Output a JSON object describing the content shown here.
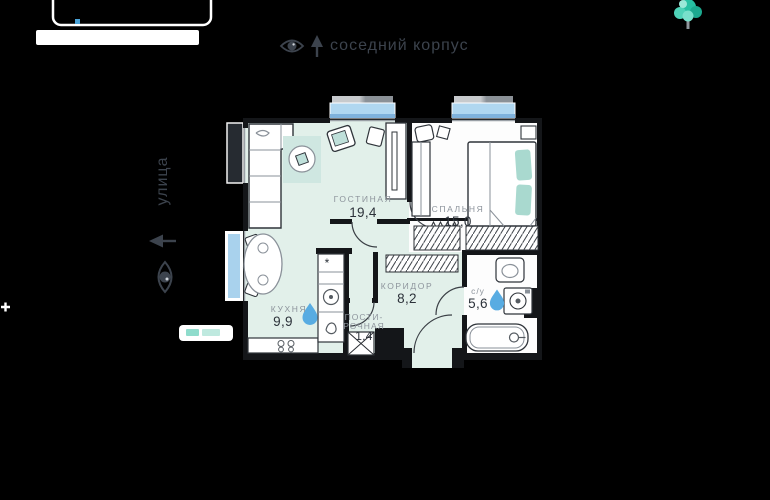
{
  "canvas": {
    "background": "#000000"
  },
  "annotations": {
    "top": {
      "icon": "eye-icon",
      "arrow": "up",
      "text": "соседний корпус"
    },
    "left": {
      "icon": "eye-icon",
      "arrow": "left",
      "text": "улица"
    }
  },
  "plan": {
    "rooms": [
      {
        "key": "living",
        "name": "ГОСТИНАЯ",
        "area": "19,4"
      },
      {
        "key": "bedroom",
        "name": "СПАЛЬНЯ",
        "area": "15,0"
      },
      {
        "key": "kitchen",
        "name": "КУХНЯ",
        "area": "9,9",
        "water": true
      },
      {
        "key": "corridor",
        "name": "КОРИДОР",
        "area": "8,2"
      },
      {
        "key": "bathroom",
        "name": "с/у",
        "area": "5,6",
        "water": true
      },
      {
        "key": "laundry",
        "name_line1": "ПОСТИ-",
        "name_line2": "РОЧНАЯ",
        "area": "1,4"
      }
    ],
    "symbols": {
      "fridge": "*"
    },
    "colors": {
      "floor_mint": "#e2f0ea",
      "rug": "#cfe7e1",
      "accent_teal": "#aedbd2",
      "window_blue": "#b0d7f0",
      "window_blue_dark": "#7fb2dc",
      "water_drop": "#58ace2",
      "tree": "#2cc3a7",
      "wall": "#141619",
      "room_label": "#8d949c",
      "area_text": "#2c323a",
      "annotation": "#3c434d"
    }
  }
}
